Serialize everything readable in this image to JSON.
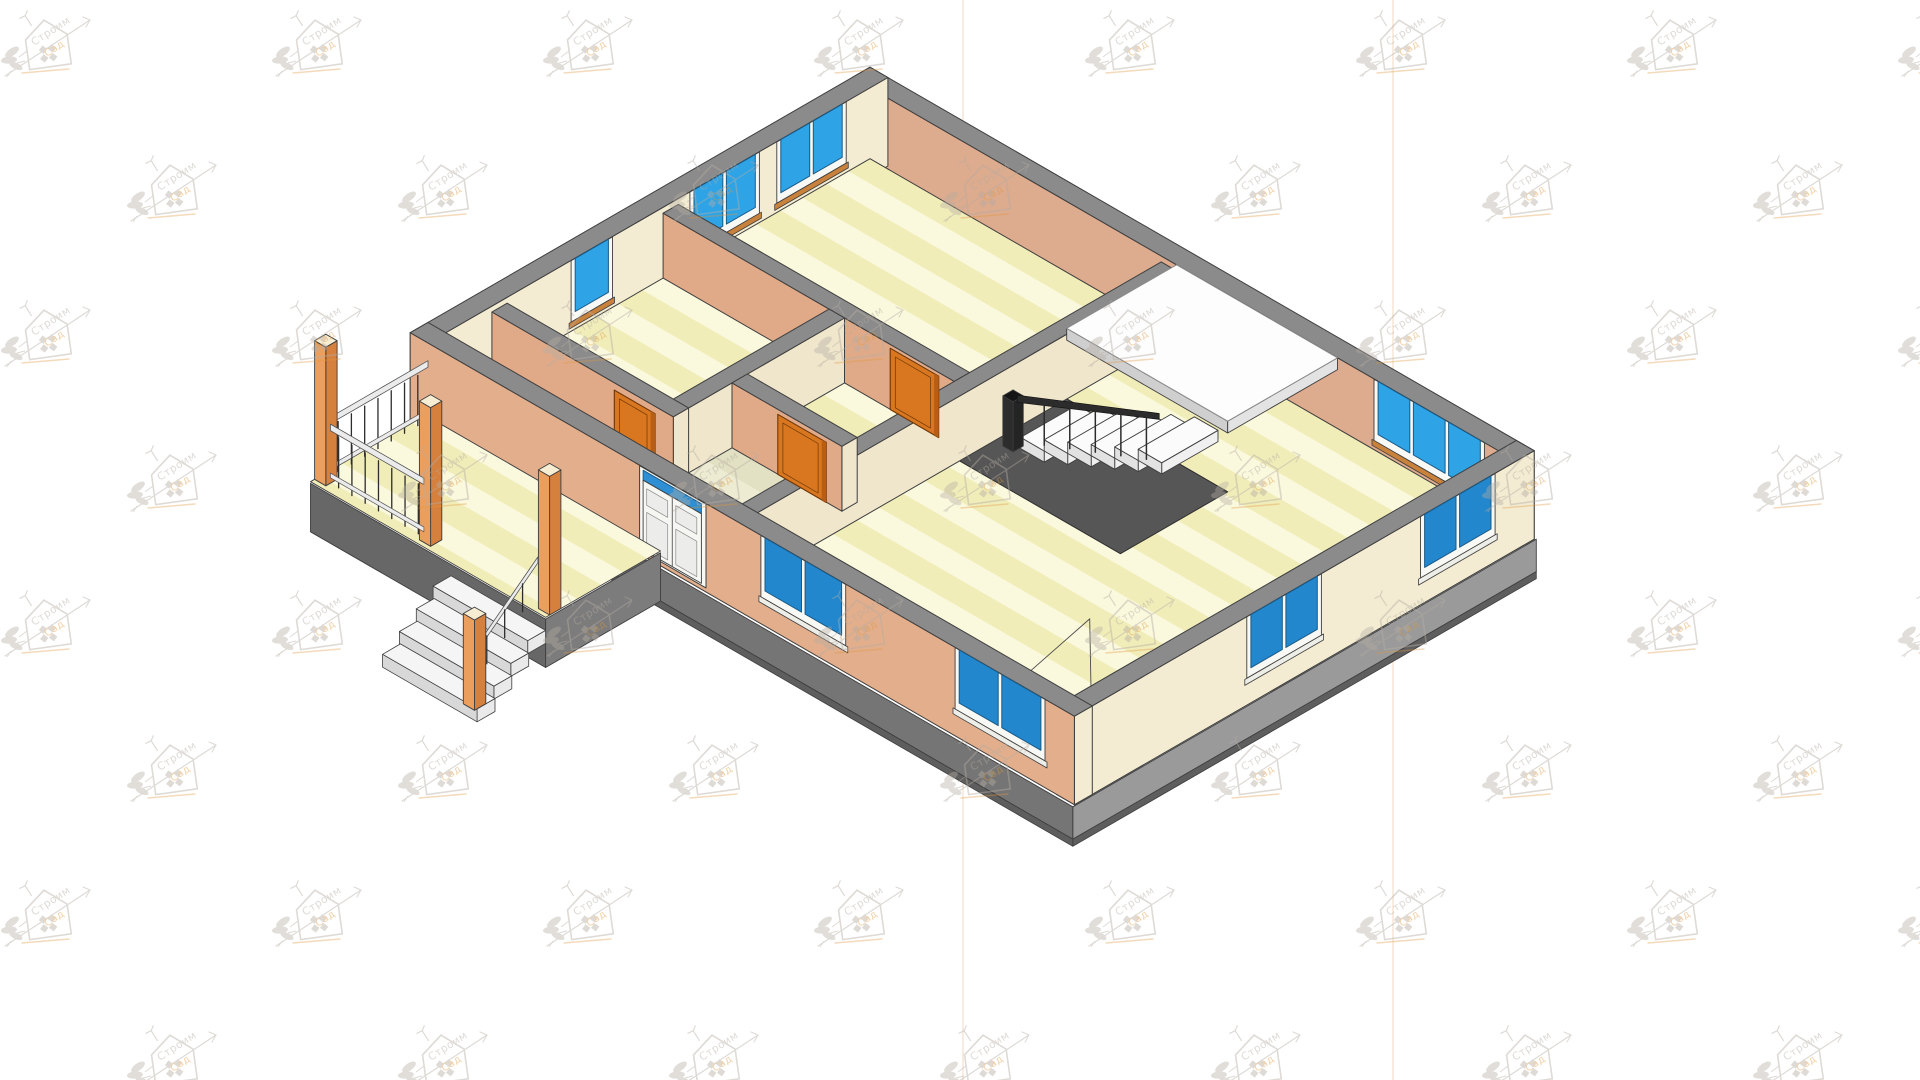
{
  "page": {
    "width": 1920,
    "height": 1080,
    "background": "#ffffff"
  },
  "render": {
    "type": "isometric-3d-floor-plan-cutaway",
    "style": "CAD architectural visualization, walls sectioned at ~1.2 m",
    "view": "bird's-eye isometric"
  },
  "watermark": {
    "word1": "Строим",
    "word2": "Сад",
    "logo": "house-with-branch-and-leaves",
    "grid": {
      "x_step": 271,
      "y_step": 145,
      "row_offset": 126
    }
  },
  "reference_lines": {
    "vertical_x": [
      963,
      1393
    ]
  },
  "house": {
    "exterior_walls": {
      "cut_top": "gray",
      "sw_faces": "peach",
      "se_faces": "cream",
      "cut_height_m": 1.2
    },
    "rooms": [
      {
        "name": "bedroom-top",
        "windows": "2 double windows on NW wall"
      },
      {
        "name": "bedroom-left",
        "windows": "1 window on NW wall"
      },
      {
        "name": "hallway",
        "doors": "orange wood doors"
      },
      {
        "name": "vestibule",
        "feature": "entry behind front door"
      },
      {
        "name": "living-room-right",
        "windows": "triple window on NE wall, double windows on SE and SW walls"
      }
    ],
    "windows": {
      "glass": "blue",
      "frames": "white",
      "groups": 8
    },
    "interior_doors": {
      "count": 3,
      "color": "orange wood"
    },
    "entry_door": {
      "style": "white paneled double door with blue transom"
    },
    "stairs": {
      "treads": 6,
      "tread_color": "white",
      "railing": "dark",
      "landing": "white platform",
      "stairwell": "dark gray void"
    },
    "porch": {
      "posts": 4,
      "post_color": "orange wood",
      "steps": 4,
      "railing": "light rails with dark balusters",
      "floor": "striped yellow decking"
    },
    "foundation": "gray concrete band"
  },
  "colors": {
    "background": "#ffffff",
    "outline": "#3e3e3e",
    "wall_top": "#8b8b8b",
    "wall_peach": "#e2ae8c",
    "wall_peach_inner": "#ddab8d",
    "wall_cream": "#f3ecd2",
    "partition_cream": "#efe6cb",
    "partition_peach": "#e0aa88",
    "floor_base": "#f1edb9",
    "floor_stripe": "#faf8dd",
    "vest_base": "#e3e1c3",
    "vest_stripe": "#edebd2",
    "glass_inner": "#2ea4e6",
    "glass_outer": "#2387cd",
    "glass_stroke": "#1a5a86",
    "frame_white": "#f8f8f5",
    "sill_tan": "#c9823c",
    "sill_white": "#eeeee8",
    "door_orange": "#d8771f",
    "door_orange_dark": "#b85e14",
    "door_stroke": "#6e3608",
    "door_white": "#f6f6f3",
    "transom_blue": "#2e8fd4",
    "void_dark": "#565656",
    "tread_top": "#fbfbfb",
    "tread_side": "#e2e2e2",
    "tread_face": "#f0f0f0",
    "landing": "#fdfdfd",
    "landing_edge": "#cfcfcf",
    "rail_dark": "#2c2c2c",
    "rail_light": "#ebebeb",
    "post_orange": "#eb9f5e",
    "post_side": "#d6803e",
    "post_top": "#f7edd3",
    "foundation_se": "#9a9a9a",
    "foundation_sw": "#757575",
    "foundation_dark": "#5e5e5e",
    "ref_line": "#eac9a2",
    "wm_gray": "#b5ada4",
    "wm_orange": "#e0993f"
  }
}
